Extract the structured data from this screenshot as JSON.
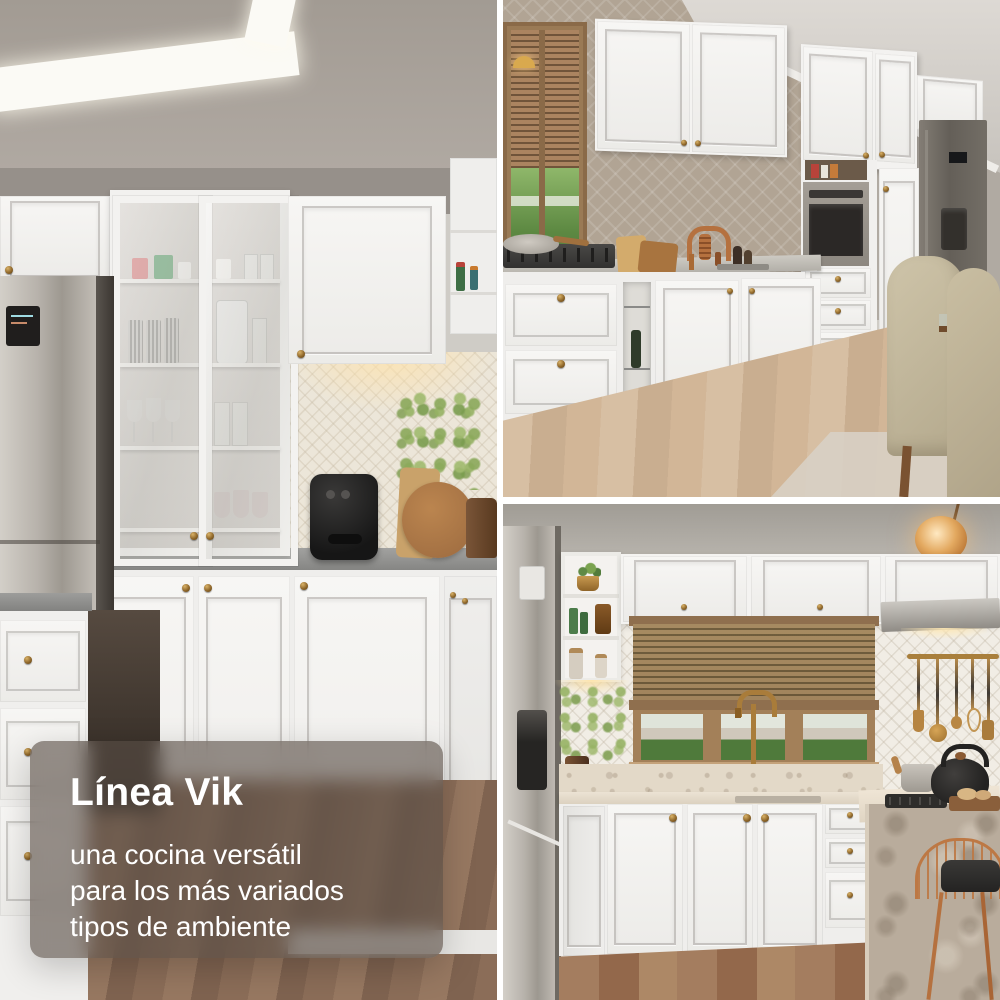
{
  "overlay": {
    "title": "Línea Vik",
    "lines": [
      "una cocina versátil",
      "para los más variados",
      "tipos de ambiente"
    ]
  },
  "palette": {
    "gutter": "#ffffff",
    "overlay_bg": "rgba(88,78,70,0.62)",
    "overlay_text": "#ffffff",
    "cabinet_white": "#f3f2f0",
    "brass": "#8a6226",
    "copper": "#b5713f",
    "taupe_wall": "#b1a494",
    "gray_ceiling": "#a8a19a",
    "counter_gray": "#8f8f8d",
    "marble_beige": "#ddd2c2",
    "steel": "#b3ada6",
    "graphite": "#6b655f",
    "wood_frame": "#a98b6a",
    "wood_floor_dark": "#8b6d58",
    "wood_floor_light": "#cfb69c",
    "greenery": "#7aa34f",
    "air_fryer_black": "#1d1c1b",
    "pendant_amber": "#d99a4e"
  }
}
